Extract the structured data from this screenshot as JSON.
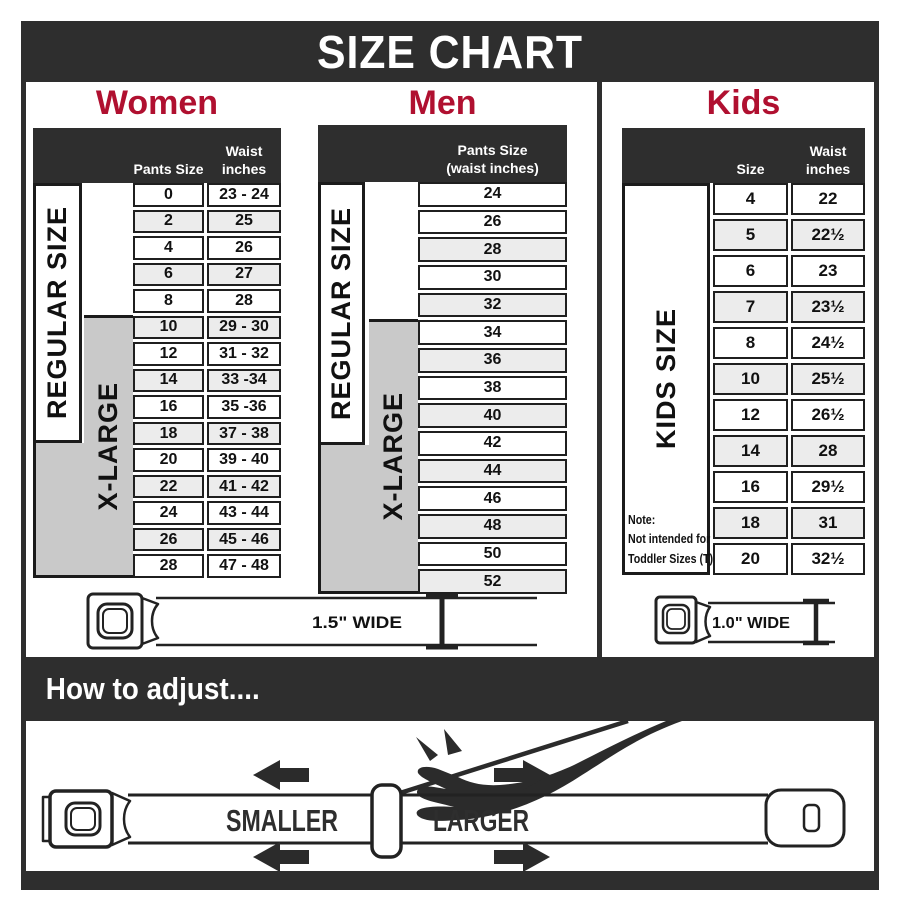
{
  "title": "SIZE CHART",
  "colors": {
    "dark": "#2e2e2e",
    "red": "#b01030",
    "row_shaded": "#ececec",
    "xlarge_gray": "#c9c9c9"
  },
  "sections": {
    "women": {
      "heading": "Women",
      "size_labels": {
        "regular": "REGULAR SIZE",
        "xlarge": "X-LARGE"
      },
      "table": {
        "headers": {
          "col1": "Pants Size",
          "col2_line1": "Waist",
          "col2_line2": "inches"
        },
        "rows": [
          {
            "cells": [
              "0",
              "23 - 24"
            ],
            "shaded": false
          },
          {
            "cells": [
              "2",
              "25"
            ],
            "shaded": true
          },
          {
            "cells": [
              "4",
              "26"
            ],
            "shaded": false
          },
          {
            "cells": [
              "6",
              "27"
            ],
            "shaded": true
          },
          {
            "cells": [
              "8",
              "28"
            ],
            "shaded": false
          },
          {
            "cells": [
              "10",
              "29 - 30"
            ],
            "shaded": true
          },
          {
            "cells": [
              "12",
              "31 - 32"
            ],
            "shaded": false
          },
          {
            "cells": [
              "14",
              "33 -34"
            ],
            "shaded": true
          },
          {
            "cells": [
              "16",
              "35 -36"
            ],
            "shaded": false
          },
          {
            "cells": [
              "18",
              "37 - 38"
            ],
            "shaded": true
          },
          {
            "cells": [
              "20",
              "39 - 40"
            ],
            "shaded": false
          },
          {
            "cells": [
              "22",
              "41 - 42"
            ],
            "shaded": true
          },
          {
            "cells": [
              "24",
              "43 - 44"
            ],
            "shaded": false
          },
          {
            "cells": [
              "26",
              "45 - 46"
            ],
            "shaded": true
          },
          {
            "cells": [
              "28",
              "47 - 48"
            ],
            "shaded": false
          }
        ]
      }
    },
    "men": {
      "heading": "Men",
      "size_labels": {
        "regular": "REGULAR SIZE",
        "xlarge": "X-LARGE"
      },
      "table": {
        "headers": {
          "line1": "Pants Size",
          "line2": "(waist inches)"
        },
        "rows": [
          {
            "cells": [
              "24"
            ],
            "shaded": false
          },
          {
            "cells": [
              "26"
            ],
            "shaded": false
          },
          {
            "cells": [
              "28"
            ],
            "shaded": true
          },
          {
            "cells": [
              "30"
            ],
            "shaded": false
          },
          {
            "cells": [
              "32"
            ],
            "shaded": true
          },
          {
            "cells": [
              "34"
            ],
            "shaded": false
          },
          {
            "cells": [
              "36"
            ],
            "shaded": true
          },
          {
            "cells": [
              "38"
            ],
            "shaded": false
          },
          {
            "cells": [
              "40"
            ],
            "shaded": true
          },
          {
            "cells": [
              "42"
            ],
            "shaded": false
          },
          {
            "cells": [
              "44"
            ],
            "shaded": true
          },
          {
            "cells": [
              "46"
            ],
            "shaded": false
          },
          {
            "cells": [
              "48"
            ],
            "shaded": true
          },
          {
            "cells": [
              "50"
            ],
            "shaded": false
          },
          {
            "cells": [
              "52"
            ],
            "shaded": true
          }
        ]
      }
    },
    "kids": {
      "heading": "Kids",
      "size_label": "KIDS SIZE",
      "table": {
        "headers": {
          "col1": "Size",
          "col2_line1": "Waist",
          "col2_line2": "inches"
        },
        "rows": [
          {
            "cells": [
              "4",
              "22"
            ],
            "shaded": false
          },
          {
            "cells": [
              "5",
              "22½"
            ],
            "shaded": true
          },
          {
            "cells": [
              "6",
              "23"
            ],
            "shaded": false
          },
          {
            "cells": [
              "7",
              "23½"
            ],
            "shaded": true
          },
          {
            "cells": [
              "8",
              "24½"
            ],
            "shaded": false
          },
          {
            "cells": [
              "10",
              "25½"
            ],
            "shaded": true
          },
          {
            "cells": [
              "12",
              "26½"
            ],
            "shaded": false
          },
          {
            "cells": [
              "14",
              "28"
            ],
            "shaded": true
          },
          {
            "cells": [
              "16",
              "29½"
            ],
            "shaded": false
          },
          {
            "cells": [
              "18",
              "31"
            ],
            "shaded": true
          },
          {
            "cells": [
              "20",
              "32½"
            ],
            "shaded": false
          }
        ]
      },
      "note": {
        "line1": "Note:",
        "line2": "Not intended for",
        "line3": "Toddler Sizes (T)"
      }
    }
  },
  "belts": {
    "adult_width_label": "1.5\" WIDE",
    "kids_width_label": "1.0\" WIDE"
  },
  "adjust": {
    "heading": "How to adjust....",
    "smaller_label": "SMALLER",
    "larger_label": "LARGER"
  }
}
